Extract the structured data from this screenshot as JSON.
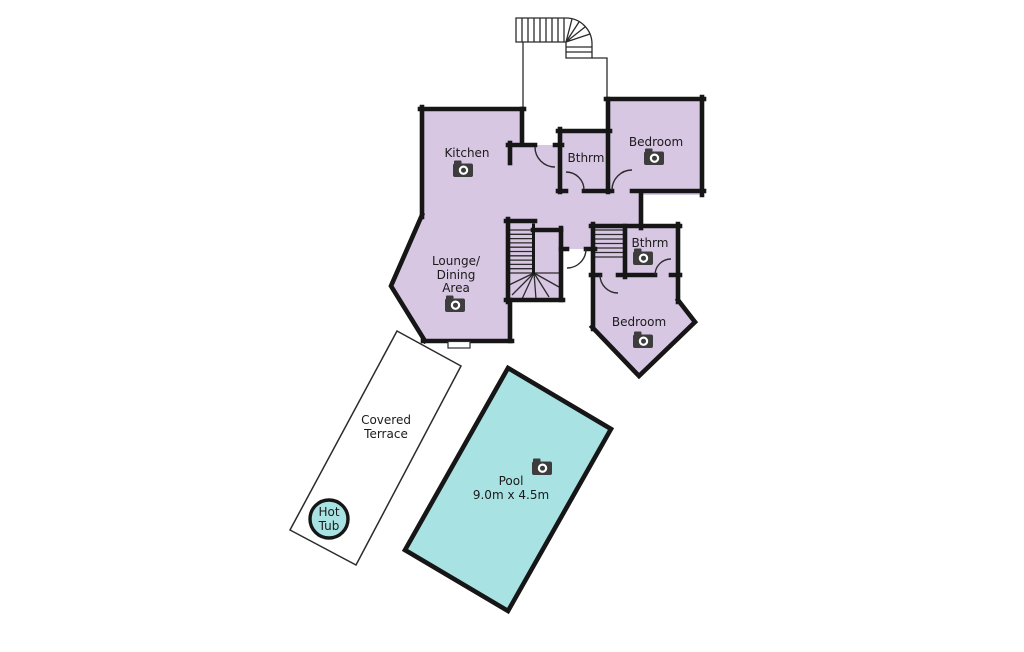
{
  "floorplan": {
    "labels": {
      "kitchen": "Kitchen",
      "bathroom_upper": "Bthrm",
      "bedroom_upper": "Bedroom",
      "lounge_line1": "Lounge/",
      "lounge_line2": "Dining",
      "lounge_line3": "Area",
      "bathroom_lower": "Bthrm",
      "bedroom_lower": "Bedroom",
      "terrace_line1": "Covered",
      "terrace_line2": "Terrace",
      "hot_tub_line1": "Hot",
      "hot_tub_line2": "Tub",
      "pool": "Pool",
      "pool_dimensions": "9.0m x 4.5m"
    },
    "colors": {
      "room_fill": "#d8c7e3",
      "water_fill": "#a9e2e2",
      "wall": "#161616",
      "line": "#2b2b2b",
      "text": "#1a1a1a",
      "icon": "#3d3d3d",
      "background": "#ffffff"
    }
  }
}
